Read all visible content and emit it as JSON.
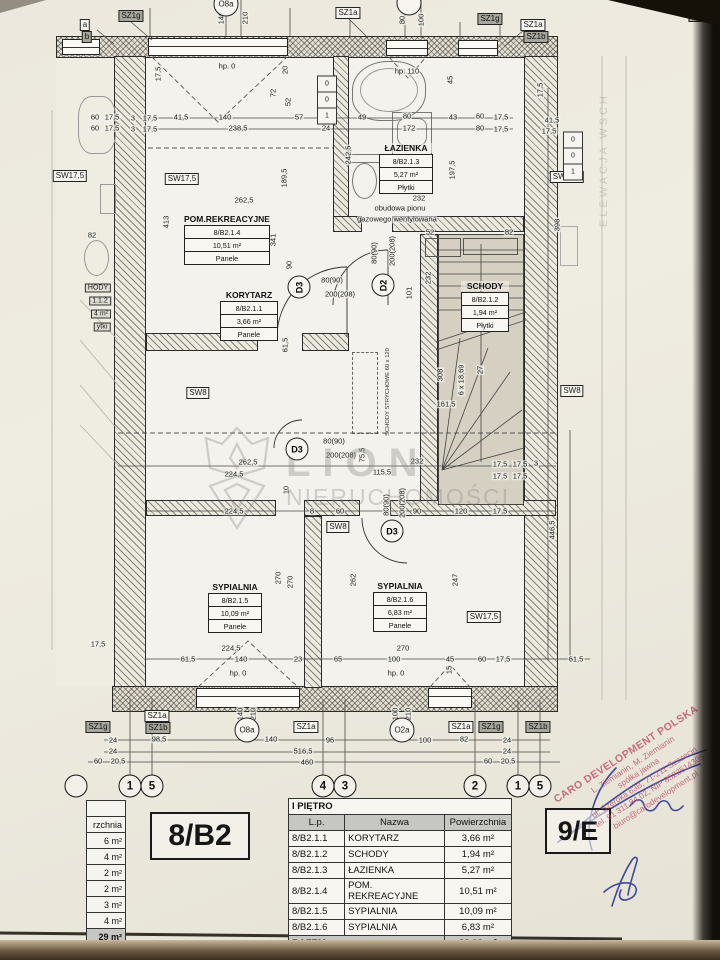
{
  "unit": {
    "label": "8/B2",
    "neighbor_label": "9/E"
  },
  "table": {
    "title": "I PIĘTRO",
    "columns": [
      "L.p.",
      "Nazwa",
      "Powierzchnia"
    ],
    "rows": [
      [
        "8/B2.1.1",
        "KORYTARZ",
        "3,66 m²"
      ],
      [
        "8/B2.1.2",
        "SCHODY",
        "1,94 m²"
      ],
      [
        "8/B2.1.3",
        "ŁAZIENKA",
        "5,27 m²"
      ],
      [
        "8/B2.1.4",
        "POM. REKREACYJNE",
        "10,51 m²"
      ],
      [
        "8/B2.1.5",
        "SYPIALNIA",
        "10,09 m²"
      ],
      [
        "8/B2.1.6",
        "SYPIALNIA",
        "6,83 m²"
      ]
    ],
    "total_label": "RAZEM",
    "total_value": "38,28 m²"
  },
  "left_table_fragment": {
    "header_fragment": "rzchnia",
    "values": [
      "6 m²",
      "4 m²",
      "2 m²",
      "2 m²",
      "3 m²",
      "4 m²"
    ],
    "total_fragment": "29 m²"
  },
  "rooms": [
    {
      "name": "POM.REKREACYJNE",
      "id": "8/B2.1.4",
      "area": "10,51 m²",
      "floor": "Panele"
    },
    {
      "name": "KORYTARZ",
      "id": "8/B2.1.1",
      "area": "3,66 m²",
      "floor": "Panele"
    },
    {
      "name": "ŁAZIENKA",
      "id": "8/B2.1.3",
      "area": "5,27 m²",
      "floor": "Płytki"
    },
    {
      "name": "SCHODY",
      "id": "8/B2.1.2",
      "area": "1,94 m²",
      "floor": "Płytki"
    },
    {
      "name": "SYPIALNIA",
      "id": "8/B2.1.5",
      "area": "10,09 m²",
      "floor": "Panele"
    },
    {
      "name": "SYPIALNIA",
      "id": "8/B2.1.6",
      "area": "6,83 m²",
      "floor": "Panele"
    }
  ],
  "doors": [
    {
      "tag": "D3"
    },
    {
      "tag": "D2"
    },
    {
      "tag": "D3"
    },
    {
      "tag": "D3"
    }
  ],
  "notes": {
    "shaft_line1": "obudowa pionu",
    "shaft_line2": "gazowego wentylowana",
    "attic_stairs": "SCHODY STRYCHOWE 60 x 120",
    "elevation_fragment": "ELEWACJA WSCH"
  },
  "watermark": {
    "line1": "LION",
    "line2": "NIERUCHOMOŚCI"
  },
  "stamp": {
    "company": "CARO DEVELOPMENT POLSKA",
    "line2": "L. Ziemianin, M. Ziemianin",
    "line3": "spółka jawna",
    "line4": "ul. Szeroka 63B, 71-211 Szczecin",
    "line5": "tel. 91 311 84 02, NIP 8522514305",
    "line6": "biuro@carodevelopment.pl",
    "color": "#c2566e"
  },
  "grid_bubbles": [
    "1",
    "5",
    "4",
    "3",
    "2",
    "1",
    "5"
  ],
  "annotations": [
    {
      "t": "SZ1g",
      "c": "tagd",
      "x": 131,
      "y": 16
    },
    {
      "t": "140",
      "c": "dv",
      "x": 221,
      "y": 18
    },
    {
      "t": "210",
      "c": "dv",
      "x": 245,
      "y": 18
    },
    {
      "t": "SZ1a",
      "c": "tag",
      "x": 348,
      "y": 13
    },
    {
      "t": "80",
      "c": "dv",
      "x": 402,
      "y": 20
    },
    {
      "t": "100",
      "c": "dv",
      "x": 421,
      "y": 20
    },
    {
      "t": "SZ1g",
      "c": "tagd",
      "x": 490,
      "y": 19
    },
    {
      "t": "SZ1a",
      "c": "tag",
      "x": 533,
      "y": 25
    },
    {
      "t": "SZ1b",
      "c": "tagd",
      "x": 536,
      "y": 37
    },
    {
      "t": "SZ1g",
      "c": "tagd",
      "x": 701,
      "y": 16
    },
    {
      "t": "a",
      "c": "tag",
      "x": 85,
      "y": 25
    },
    {
      "t": "b",
      "c": "tagd",
      "x": 87,
      "y": 37
    },
    {
      "t": "O8a",
      "c": "circ",
      "x": 226,
      "y": 4
    },
    {
      "t": "",
      "c": "circ",
      "x": 409,
      "y": 3
    },
    {
      "t": "hp. 0",
      "c": "d",
      "x": 227,
      "y": 66
    },
    {
      "t": "17,5",
      "c": "dv",
      "x": 158,
      "y": 74
    },
    {
      "t": "20",
      "c": "dv",
      "x": 285,
      "y": 70
    },
    {
      "t": "72",
      "c": "dv",
      "x": 273,
      "y": 93
    },
    {
      "t": "52",
      "c": "dv",
      "x": 288,
      "y": 102
    },
    {
      "t": "3",
      "c": "d",
      "x": 133,
      "y": 118
    },
    {
      "t": "17,5",
      "c": "d",
      "x": 150,
      "y": 118
    },
    {
      "t": "41,5",
      "c": "d",
      "x": 181,
      "y": 117
    },
    {
      "t": "140",
      "c": "d",
      "x": 225,
      "y": 117
    },
    {
      "t": "57",
      "c": "d",
      "x": 299,
      "y": 117
    },
    {
      "t": "24",
      "c": "d",
      "x": 326,
      "y": 116
    },
    {
      "t": "3",
      "c": "d",
      "x": 133,
      "y": 129
    },
    {
      "t": "17,5",
      "c": "d",
      "x": 150,
      "y": 129
    },
    {
      "t": "238,5",
      "c": "d",
      "x": 238,
      "y": 128
    },
    {
      "t": "24",
      "c": "d",
      "x": 326,
      "y": 128
    },
    {
      "t": "413",
      "c": "dv",
      "x": 166,
      "y": 222
    },
    {
      "t": "262,5",
      "c": "d",
      "x": 244,
      "y": 200
    },
    {
      "t": "189,5",
      "c": "dv",
      "x": 284,
      "y": 178
    },
    {
      "t": "341",
      "c": "dv",
      "x": 273,
      "y": 240
    },
    {
      "t": "90",
      "c": "dv",
      "x": 289,
      "y": 265
    },
    {
      "t": "61,5",
      "c": "dv",
      "x": 285,
      "y": 345
    },
    {
      "t": "60",
      "c": "d",
      "x": 95,
      "y": 117
    },
    {
      "t": "17,5",
      "c": "d",
      "x": 112,
      "y": 117
    },
    {
      "t": "60",
      "c": "d",
      "x": 95,
      "y": 128
    },
    {
      "t": "17,5",
      "c": "d",
      "x": 112,
      "y": 128
    },
    {
      "t": "82",
      "c": "d",
      "x": 92,
      "y": 235
    },
    {
      "t": "SW17,5",
      "c": "tag",
      "x": 70,
      "y": 176
    },
    {
      "t": "17,5",
      "c": "d",
      "x": 98,
      "y": 644
    },
    {
      "t": "HODY",
      "c": "frag",
      "x": 98,
      "y": 288
    },
    {
      "t": "1.1.2",
      "c": "frag",
      "x": 100,
      "y": 301
    },
    {
      "t": "4 m²",
      "c": "frag",
      "x": 101,
      "y": 314
    },
    {
      "t": "ytki",
      "c": "frag",
      "x": 102,
      "y": 327
    },
    {
      "t": "hp: 110",
      "c": "d",
      "x": 407,
      "y": 71
    },
    {
      "t": "45",
      "c": "dv",
      "x": 450,
      "y": 80
    },
    {
      "t": "49",
      "c": "d",
      "x": 362,
      "y": 117
    },
    {
      "t": "80",
      "c": "d",
      "x": 407,
      "y": 116
    },
    {
      "t": "43",
      "c": "d",
      "x": 453,
      "y": 117
    },
    {
      "t": "60",
      "c": "d",
      "x": 480,
      "y": 116
    },
    {
      "t": "17,5",
      "c": "d",
      "x": 501,
      "y": 117
    },
    {
      "t": "172",
      "c": "d",
      "x": 409,
      "y": 128
    },
    {
      "t": "80",
      "c": "d",
      "x": 480,
      "y": 128
    },
    {
      "t": "17,5",
      "c": "d",
      "x": 501,
      "y": 129
    },
    {
      "t": "242,5",
      "c": "dv",
      "x": 348,
      "y": 155
    },
    {
      "t": "197,5",
      "c": "dv",
      "x": 452,
      "y": 170
    },
    {
      "t": "232",
      "c": "d",
      "x": 419,
      "y": 198
    },
    {
      "t": "52",
      "c": "d",
      "x": 430,
      "y": 232
    },
    {
      "t": "82",
      "c": "d",
      "x": 509,
      "y": 232
    },
    {
      "t": "101",
      "c": "dv",
      "x": 409,
      "y": 293
    },
    {
      "t": "SW17,5",
      "c": "tag",
      "x": 182,
      "y": 179
    },
    {
      "t": "SW8",
      "c": "tag",
      "x": 198,
      "y": 393
    },
    {
      "t": "SW8",
      "c": "tag",
      "x": 338,
      "y": 527
    },
    {
      "t": "SW17,5",
      "c": "tag",
      "x": 567,
      "y": 177
    },
    {
      "t": "SW17,5",
      "c": "tag",
      "x": 484,
      "y": 617
    },
    {
      "t": "SW8",
      "c": "tag",
      "x": 572,
      "y": 391
    },
    {
      "t": "17,5",
      "c": "dv",
      "x": 540,
      "y": 90
    },
    {
      "t": "41,5",
      "c": "d",
      "x": 552,
      "y": 120
    },
    {
      "t": "17,5",
      "c": "d",
      "x": 549,
      "y": 131
    },
    {
      "t": "398",
      "c": "dv",
      "x": 557,
      "y": 225
    },
    {
      "t": "446,5",
      "c": "dv",
      "x": 552,
      "y": 530
    },
    {
      "t": "17,5",
      "c": "d",
      "x": 520,
      "y": 464
    },
    {
      "t": "3",
      "c": "d",
      "x": 536,
      "y": 463
    },
    {
      "t": "17,5",
      "c": "d",
      "x": 520,
      "y": 476
    },
    {
      "t": "308",
      "c": "dv",
      "x": 440,
      "y": 375
    },
    {
      "t": "6 x 18,69",
      "c": "dv",
      "x": 461,
      "y": 380
    },
    {
      "t": "27",
      "c": "dv",
      "x": 480,
      "y": 370
    },
    {
      "t": "161,5",
      "c": "d",
      "x": 446,
      "y": 404
    },
    {
      "t": "232",
      "c": "dv",
      "x": 428,
      "y": 278
    },
    {
      "t": "262,5",
      "c": "d",
      "x": 248,
      "y": 462
    },
    {
      "t": "224,5",
      "c": "d",
      "x": 234,
      "y": 474
    },
    {
      "t": "115,5",
      "c": "d",
      "x": 382,
      "y": 472
    },
    {
      "t": "232",
      "c": "d",
      "x": 417,
      "y": 461
    },
    {
      "t": "17,5",
      "c": "d",
      "x": 500,
      "y": 464
    },
    {
      "t": "17,5",
      "c": "d",
      "x": 500,
      "y": 476
    },
    {
      "t": "75,5",
      "c": "dv",
      "x": 362,
      "y": 455
    },
    {
      "t": "10",
      "c": "dv",
      "x": 286,
      "y": 490
    },
    {
      "t": "224,5",
      "c": "d",
      "x": 234,
      "y": 511
    },
    {
      "t": "8",
      "c": "d",
      "x": 312,
      "y": 511
    },
    {
      "t": "60",
      "c": "d",
      "x": 340,
      "y": 511
    },
    {
      "t": "90",
      "c": "d",
      "x": 417,
      "y": 511
    },
    {
      "t": "120",
      "c": "d",
      "x": 461,
      "y": 511
    },
    {
      "t": "17,5",
      "c": "d",
      "x": 500,
      "y": 511
    },
    {
      "t": "270",
      "c": "dv",
      "x": 278,
      "y": 578
    },
    {
      "t": "270",
      "c": "dv",
      "x": 290,
      "y": 582
    },
    {
      "t": "262",
      "c": "dv",
      "x": 353,
      "y": 580
    },
    {
      "t": "247",
      "c": "dv",
      "x": 455,
      "y": 580
    },
    {
      "t": "224,5",
      "c": "d",
      "x": 231,
      "y": 648
    },
    {
      "t": "61,5",
      "c": "d",
      "x": 188,
      "y": 659
    },
    {
      "t": "140",
      "c": "d",
      "x": 241,
      "y": 659
    },
    {
      "t": "23",
      "c": "d",
      "x": 298,
      "y": 659
    },
    {
      "t": "65",
      "c": "d",
      "x": 338,
      "y": 659
    },
    {
      "t": "270",
      "c": "d",
      "x": 403,
      "y": 648
    },
    {
      "t": "100",
      "c": "d",
      "x": 394,
      "y": 659
    },
    {
      "t": "45",
      "c": "d",
      "x": 450,
      "y": 659
    },
    {
      "t": "hp. 0",
      "c": "d",
      "x": 238,
      "y": 673
    },
    {
      "t": "hp. 0",
      "c": "d",
      "x": 396,
      "y": 673
    },
    {
      "t": "15",
      "c": "dv",
      "x": 449,
      "y": 670
    },
    {
      "t": "60",
      "c": "d",
      "x": 482,
      "y": 659
    },
    {
      "t": "17,5",
      "c": "d",
      "x": 503,
      "y": 659
    },
    {
      "t": "61,5",
      "c": "d",
      "x": 576,
      "y": 659
    },
    {
      "t": "80(90)",
      "c": "d",
      "x": 332,
      "y": 280
    },
    {
      "t": "200(208)",
      "c": "d",
      "x": 340,
      "y": 294
    },
    {
      "t": "80(90)",
      "c": "dv",
      "x": 374,
      "y": 253
    },
    {
      "t": "200(208)",
      "c": "dv",
      "x": 392,
      "y": 251
    },
    {
      "t": "80(90)",
      "c": "d",
      "x": 334,
      "y": 441
    },
    {
      "t": "200(208)",
      "c": "d",
      "x": 341,
      "y": 455
    },
    {
      "t": "80(90)",
      "c": "dv",
      "x": 386,
      "y": 505
    },
    {
      "t": "200(208)",
      "c": "dv",
      "x": 402,
      "y": 503
    },
    {
      "t": "SZ1g",
      "c": "tagd",
      "x": 98,
      "y": 727
    },
    {
      "t": "SZ1a",
      "c": "tag",
      "x": 157,
      "y": 716
    },
    {
      "t": "SZ1b",
      "c": "tagd",
      "x": 158,
      "y": 728
    },
    {
      "t": "140",
      "c": "dv",
      "x": 240,
      "y": 714
    },
    {
      "t": "210",
      "c": "dv",
      "x": 253,
      "y": 714
    },
    {
      "t": "O8a",
      "c": "circ",
      "x": 247,
      "y": 730
    },
    {
      "t": "140",
      "c": "d",
      "x": 271,
      "y": 739
    },
    {
      "t": "SZ1a",
      "c": "tag",
      "x": 306,
      "y": 727
    },
    {
      "t": "96",
      "c": "d",
      "x": 330,
      "y": 740
    },
    {
      "t": "100",
      "c": "dv",
      "x": 395,
      "y": 714
    },
    {
      "t": "210",
      "c": "dv",
      "x": 408,
      "y": 714
    },
    {
      "t": "O2a",
      "c": "circ",
      "x": 402,
      "y": 730
    },
    {
      "t": "100",
      "c": "d",
      "x": 425,
      "y": 740
    },
    {
      "t": "SZ1a",
      "c": "tag",
      "x": 461,
      "y": 727
    },
    {
      "t": "82",
      "c": "d",
      "x": 464,
      "y": 739
    },
    {
      "t": "SZ1g",
      "c": "tagd",
      "x": 491,
      "y": 727
    },
    {
      "t": "24",
      "c": "d",
      "x": 507,
      "y": 740
    },
    {
      "t": "SZ1b",
      "c": "tagd",
      "x": 538,
      "y": 727
    },
    {
      "t": "24",
      "c": "d",
      "x": 113,
      "y": 740
    },
    {
      "t": "98,5",
      "c": "d",
      "x": 159,
      "y": 739
    },
    {
      "t": "24",
      "c": "d",
      "x": 113,
      "y": 751
    },
    {
      "t": "516,5",
      "c": "d",
      "x": 303,
      "y": 751
    },
    {
      "t": "24",
      "c": "d",
      "x": 507,
      "y": 751
    },
    {
      "t": "60",
      "c": "d",
      "x": 98,
      "y": 761
    },
    {
      "t": "20,5",
      "c": "d",
      "x": 118,
      "y": 761
    },
    {
      "t": "460",
      "c": "d",
      "x": 307,
      "y": 762
    },
    {
      "t": "60",
      "c": "d",
      "x": 488,
      "y": 761
    },
    {
      "t": "20,5",
      "c": "d",
      "x": 508,
      "y": 761
    },
    {
      "t": "0",
      "c": "rc",
      "x": 327,
      "y": 84
    },
    {
      "t": "0",
      "c": "rc",
      "x": 327,
      "y": 100
    },
    {
      "t": "1",
      "c": "rc",
      "x": 327,
      "y": 116
    },
    {
      "t": "0",
      "c": "rc",
      "x": 573,
      "y": 140
    },
    {
      "t": "0",
      "c": "rc",
      "x": 573,
      "y": 156
    },
    {
      "t": "1",
      "c": "rc",
      "x": 573,
      "y": 172
    }
  ]
}
